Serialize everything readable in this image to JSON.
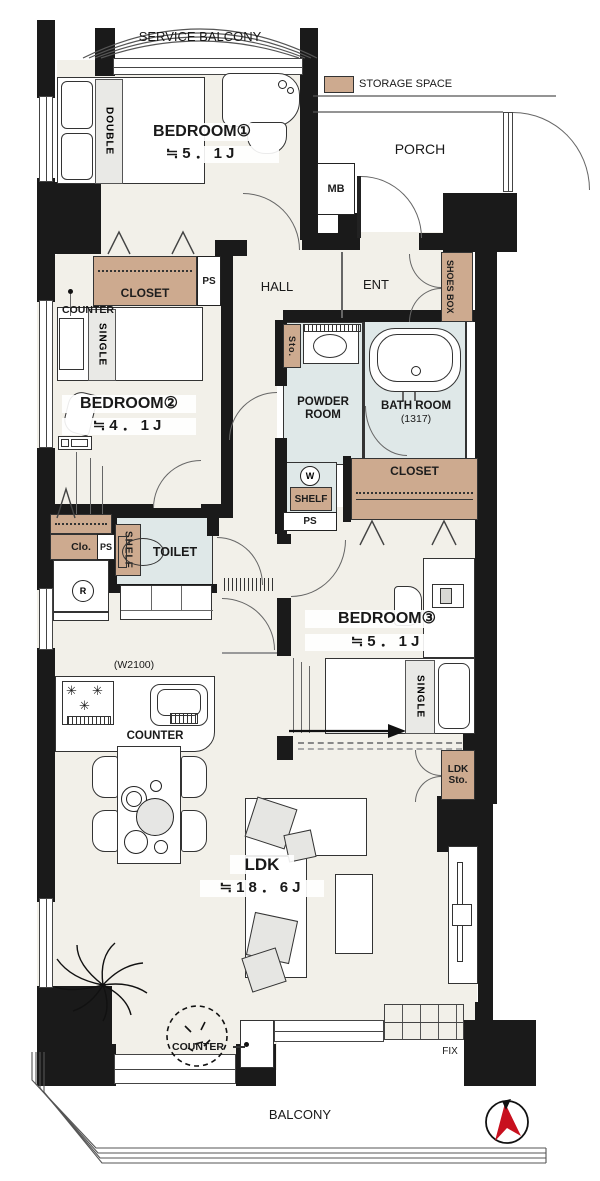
{
  "texts": {
    "service_balcony": "SERVICE BALCONY",
    "storage_space": "STORAGE SPACE",
    "bedroom1_name": "BEDROOM①",
    "bedroom1_size": "≒5．1J",
    "bedroom1_bed": "DOUBLE",
    "porch": "PORCH",
    "mb": "MB",
    "ent": "ENT",
    "shoes_box": "SHOES BOX",
    "hall": "HALL",
    "closet1": "CLOSET",
    "ps1": "PS",
    "counter_bedroom2": "COUNTER",
    "bedroom2_bed": "SINGLE",
    "bedroom2_name": "BEDROOM②",
    "bedroom2_size": "≒4．1J",
    "sto_powder": "Sto.",
    "powder_room_line1": "POWDER",
    "powder_room_line2": "ROOM",
    "bath_room": "BATH ROOM",
    "bath_size": "(1317)",
    "washer": "W",
    "shelf_powder": "SHELF",
    "ps2": "PS",
    "closet2": "CLOSET",
    "clo": "Clo.",
    "ps3": "PS",
    "shelf_toilet": "SHELF",
    "toilet": "TOILET",
    "refrigerator": "R",
    "bedroom3_name": "BEDROOM③",
    "bedroom3_size": "≒5．1J",
    "bedroom3_bed": "SINGLE",
    "kitchen_width": "(W2100)",
    "counter_kitchen": "COUNTER",
    "ldk_sto_line1": "LDK",
    "ldk_sto_line2": "Sto.",
    "ldk_name": "LDK",
    "ldk_size": "≒18．6J",
    "counter_balcony": "COUNTER",
    "fix": "FIX",
    "balcony": "BALCONY"
  },
  "icons": {
    "burner": "✳"
  },
  "colors": {
    "wall": "#1a1a1a",
    "floor": "#f2f0e9",
    "wet_area": "#dfe8e8",
    "storage": "#cdaa8f",
    "compass_red": "#c8101e"
  }
}
